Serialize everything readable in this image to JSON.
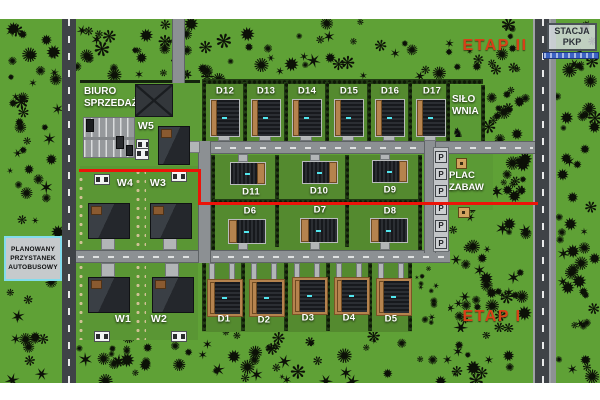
{
  "map": {
    "region_labels": {
      "etap2": "ETAP II",
      "etap1": "ETAP I",
      "biuro1": "BIURO",
      "biuro2": "SPRZEDAŻY",
      "silownia1": "SIŁO",
      "silownia2": "WNIA",
      "plac1": "PLAC",
      "plac2": "ZABAW",
      "stacja1": "STACJA",
      "stacja2": "PKP",
      "przystanek1": "PLANOWANY",
      "przystanek2": "PRZYSTANEK",
      "przystanek3": "AUTOBUSOWY"
    },
    "houses": [
      {
        "id": "D12",
        "label": "D12",
        "variant": "d-top",
        "hx": 210,
        "hy": 99,
        "lx": 225,
        "ly": 91
      },
      {
        "id": "D13",
        "label": "D13",
        "variant": "d-top",
        "hx": 251,
        "hy": 99,
        "lx": 266,
        "ly": 91
      },
      {
        "id": "D14",
        "label": "D14",
        "variant": "d-top",
        "hx": 292,
        "hy": 99,
        "lx": 307,
        "ly": 91
      },
      {
        "id": "D15",
        "label": "D15",
        "variant": "d-top",
        "hx": 334,
        "hy": 99,
        "lx": 349,
        "ly": 91
      },
      {
        "id": "D16",
        "label": "D16",
        "variant": "d-top",
        "hx": 375,
        "hy": 99,
        "lx": 390,
        "ly": 91
      },
      {
        "id": "D17",
        "label": "D17",
        "variant": "d-top",
        "hx": 416,
        "hy": 99,
        "lx": 432,
        "ly": 91
      },
      {
        "id": "D11",
        "label": "D11",
        "variant": "d-wide-r",
        "hx": 230,
        "hy": 162,
        "lx": 251,
        "ly": 192
      },
      {
        "id": "D10",
        "label": "D10",
        "variant": "d-wide-r",
        "hx": 302,
        "hy": 161,
        "lx": 319,
        "ly": 191
      },
      {
        "id": "D9",
        "label": "D9",
        "variant": "d-wide-r",
        "hx": 372,
        "hy": 160,
        "lx": 390,
        "ly": 190
      },
      {
        "id": "D6",
        "label": "D6",
        "variant": "d-wide-l",
        "hx": 228,
        "hy": 219,
        "lx": 250,
        "ly": 211
      },
      {
        "id": "D7",
        "label": "D7",
        "variant": "d-wide-l",
        "hx": 300,
        "hy": 218,
        "lx": 320,
        "ly": 210
      },
      {
        "id": "D8",
        "label": "D8",
        "variant": "d-wide-l",
        "hx": 370,
        "hy": 218,
        "lx": 390,
        "ly": 211
      },
      {
        "id": "D1",
        "label": "D1",
        "variant": "d-frame",
        "hx": 208,
        "hy": 280,
        "lx": 224,
        "ly": 319
      },
      {
        "id": "D2",
        "label": "D2",
        "variant": "d-frame",
        "hx": 250,
        "hy": 280,
        "lx": 264,
        "ly": 320
      },
      {
        "id": "D3",
        "label": "D3",
        "variant": "d-frame",
        "hx": 293,
        "hy": 278,
        "lx": 308,
        "ly": 318
      },
      {
        "id": "D4",
        "label": "D4",
        "variant": "d-frame",
        "hx": 335,
        "hy": 278,
        "lx": 349,
        "ly": 318
      },
      {
        "id": "D5",
        "label": "D5",
        "variant": "d-frame",
        "hx": 377,
        "hy": 279,
        "lx": 391,
        "ly": 319
      },
      {
        "id": "W4",
        "label": "W4",
        "variant": "w",
        "hx": 88,
        "hy": 203,
        "lx": 125,
        "ly": 183
      },
      {
        "id": "W3",
        "label": "W3",
        "variant": "w",
        "hx": 150,
        "hy": 203,
        "lx": 158,
        "ly": 183
      },
      {
        "id": "W1",
        "label": "W1",
        "variant": "w",
        "hx": 88,
        "hy": 277,
        "lx": 123,
        "ly": 319
      },
      {
        "id": "W2",
        "label": "W2",
        "variant": "w",
        "hx": 152,
        "hy": 277,
        "lx": 159,
        "ly": 319
      },
      {
        "id": "W5",
        "label": "W5",
        "variant": "w5",
        "hx": 158,
        "hy": 126,
        "lx": 146,
        "ly": 126
      }
    ],
    "parking_spots": [
      "P",
      "P",
      "P",
      "P",
      "P",
      "P"
    ],
    "colors": {
      "boundary_red": "#ec1309",
      "etap_text": "#d84018",
      "grass": "#5fa136",
      "lot_grass": "#548a2f",
      "tree": "#0c1107",
      "tan_garage": "#b5834e",
      "bus_sign_border": "#82dcec",
      "pkp_blue": "#3c63c4"
    }
  }
}
